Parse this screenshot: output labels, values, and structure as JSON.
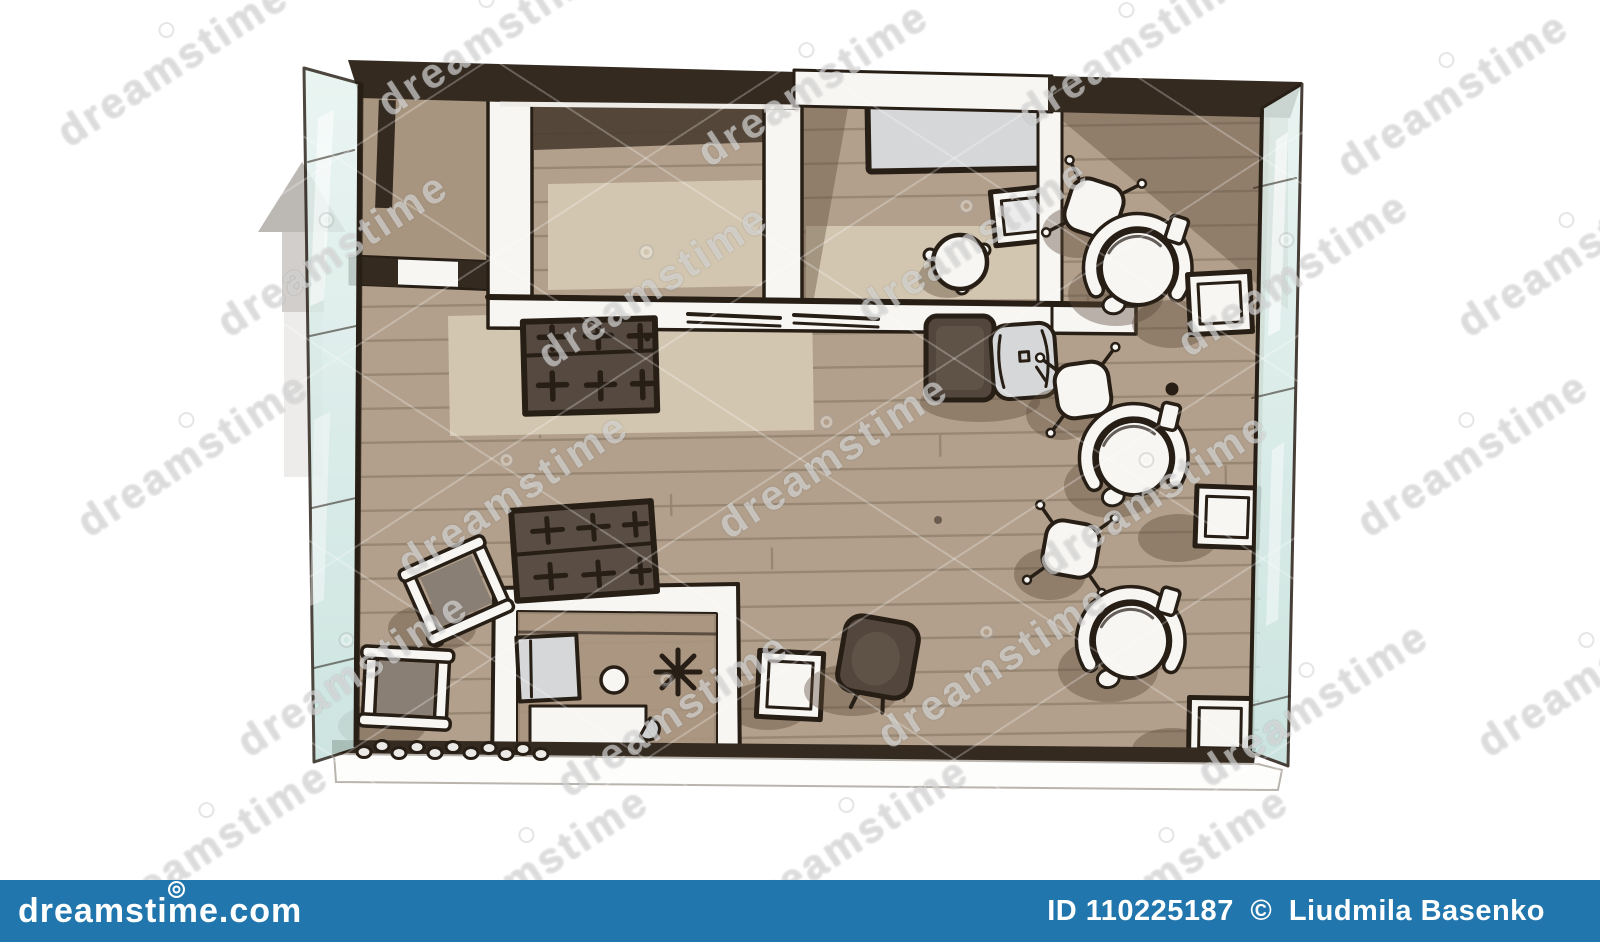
{
  "image": {
    "description": "Hand-drawn watercolor architectural sketch of a studio interior floor plan, top view, brown wood floor, glass walls left and right",
    "style": "stock photo with watermarks"
  },
  "watermark": {
    "text": "dreamstime"
  },
  "footer": {
    "site": "dreamstime.com",
    "id_text": "ID 110225187",
    "copyright": "©",
    "author": "Liudmila Basenko"
  },
  "palette": {
    "ink": "#271e15",
    "wood": "#b2a08c",
    "wood2": "#a8957f",
    "plank": "#91816d",
    "rug": "#d2c6b0",
    "wall_dark": "#342a20",
    "wall_white": "#f7f6f3",
    "glass_light": "#e6f3f0",
    "glass_deep": "#c3dfda",
    "gray_item": "#d6d7d9",
    "dark_item": "#52463d",
    "shadow": "rgba(92,76,58,0.40)",
    "arrow_gray": "#b5b1ad",
    "footer_blue": "#2177ad"
  },
  "floorplan": {
    "rooms": [
      "closet",
      "kitchen",
      "bedroom",
      "lounge",
      "open-living-area"
    ],
    "furniture": [
      "closet-partition",
      "kitchen-rug",
      "bedroom-bed-table",
      "nested-side-table",
      "round-stool",
      "kitchen-counter",
      "gas-stove",
      "dark-armchair-with-chair",
      "lounge-stool-1",
      "lounge-armchair-1",
      "lounge-side-table-1",
      "lounge-stool-2",
      "lounge-armchair-2",
      "lounge-side-table-2",
      "lounge-stool-3",
      "lounge-armchair-3",
      "lounge-side-table-3",
      "kitchen-island",
      "island-gas-hob",
      "island-cabinet",
      "island-sink",
      "island-plant-star",
      "island-bathtub",
      "director-chair-1",
      "director-chair-2",
      "white-stool",
      "tilted-dark-armchair",
      "pebble-decoration",
      "north-arrow",
      "glass-wall-left",
      "glass-wall-right"
    ]
  }
}
